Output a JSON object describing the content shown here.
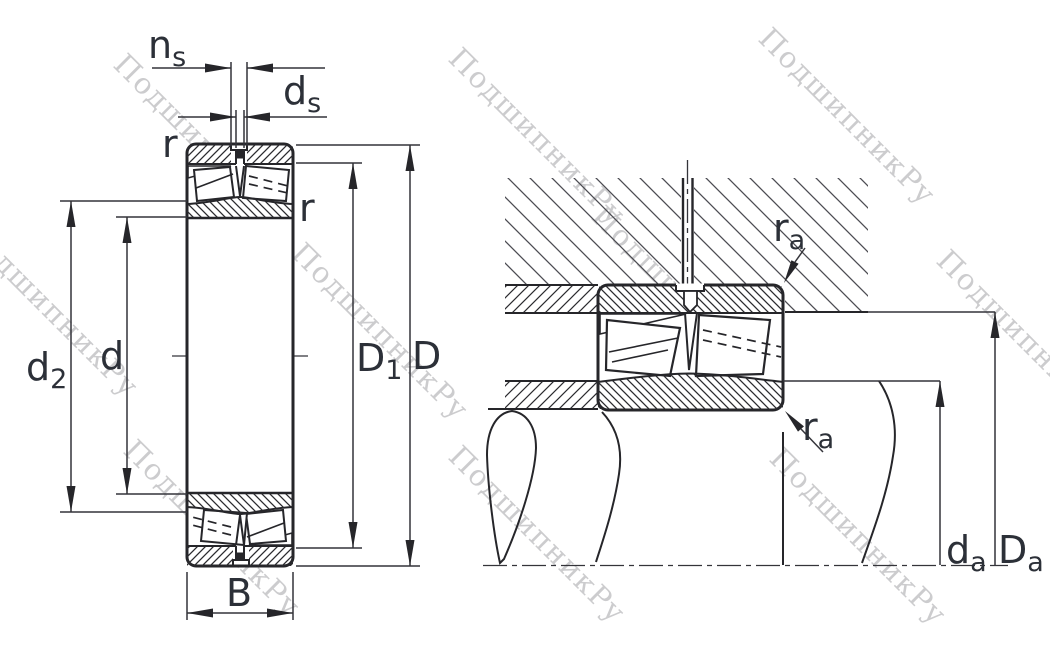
{
  "drawing": {
    "type": "bearing-dimension-drawing",
    "views": {
      "left": "spherical roller bearing cross-section with boundary dimensions",
      "right": "bearing mounted on shaft in housing with abutment dimensions"
    }
  },
  "labels": {
    "ns": {
      "base": "n",
      "sub": "s"
    },
    "ds": {
      "base": "d",
      "sub": "s"
    },
    "r_outer": "r",
    "r_inner": "r",
    "d2": {
      "base": "d",
      "sub": "2"
    },
    "d": "d",
    "D1": {
      "base": "D",
      "sub": "1"
    },
    "D": "D",
    "B": "B",
    "ra_housing": {
      "base": "r",
      "sub": "a"
    },
    "ra_shaft": {
      "base": "r",
      "sub": "a"
    },
    "da": {
      "base": "d",
      "sub": "a"
    },
    "Da": {
      "base": "D",
      "sub": "a"
    }
  },
  "watermark": {
    "text": "ПодшипникРу",
    "color": "#c8c8ca"
  },
  "colors": {
    "background": "#ffffff",
    "outline": "#26262a",
    "thin_line": "#34343a",
    "label": "#2c3038",
    "housing_hatch": "#4c4c52",
    "watermark": "#c8c8ca"
  }
}
